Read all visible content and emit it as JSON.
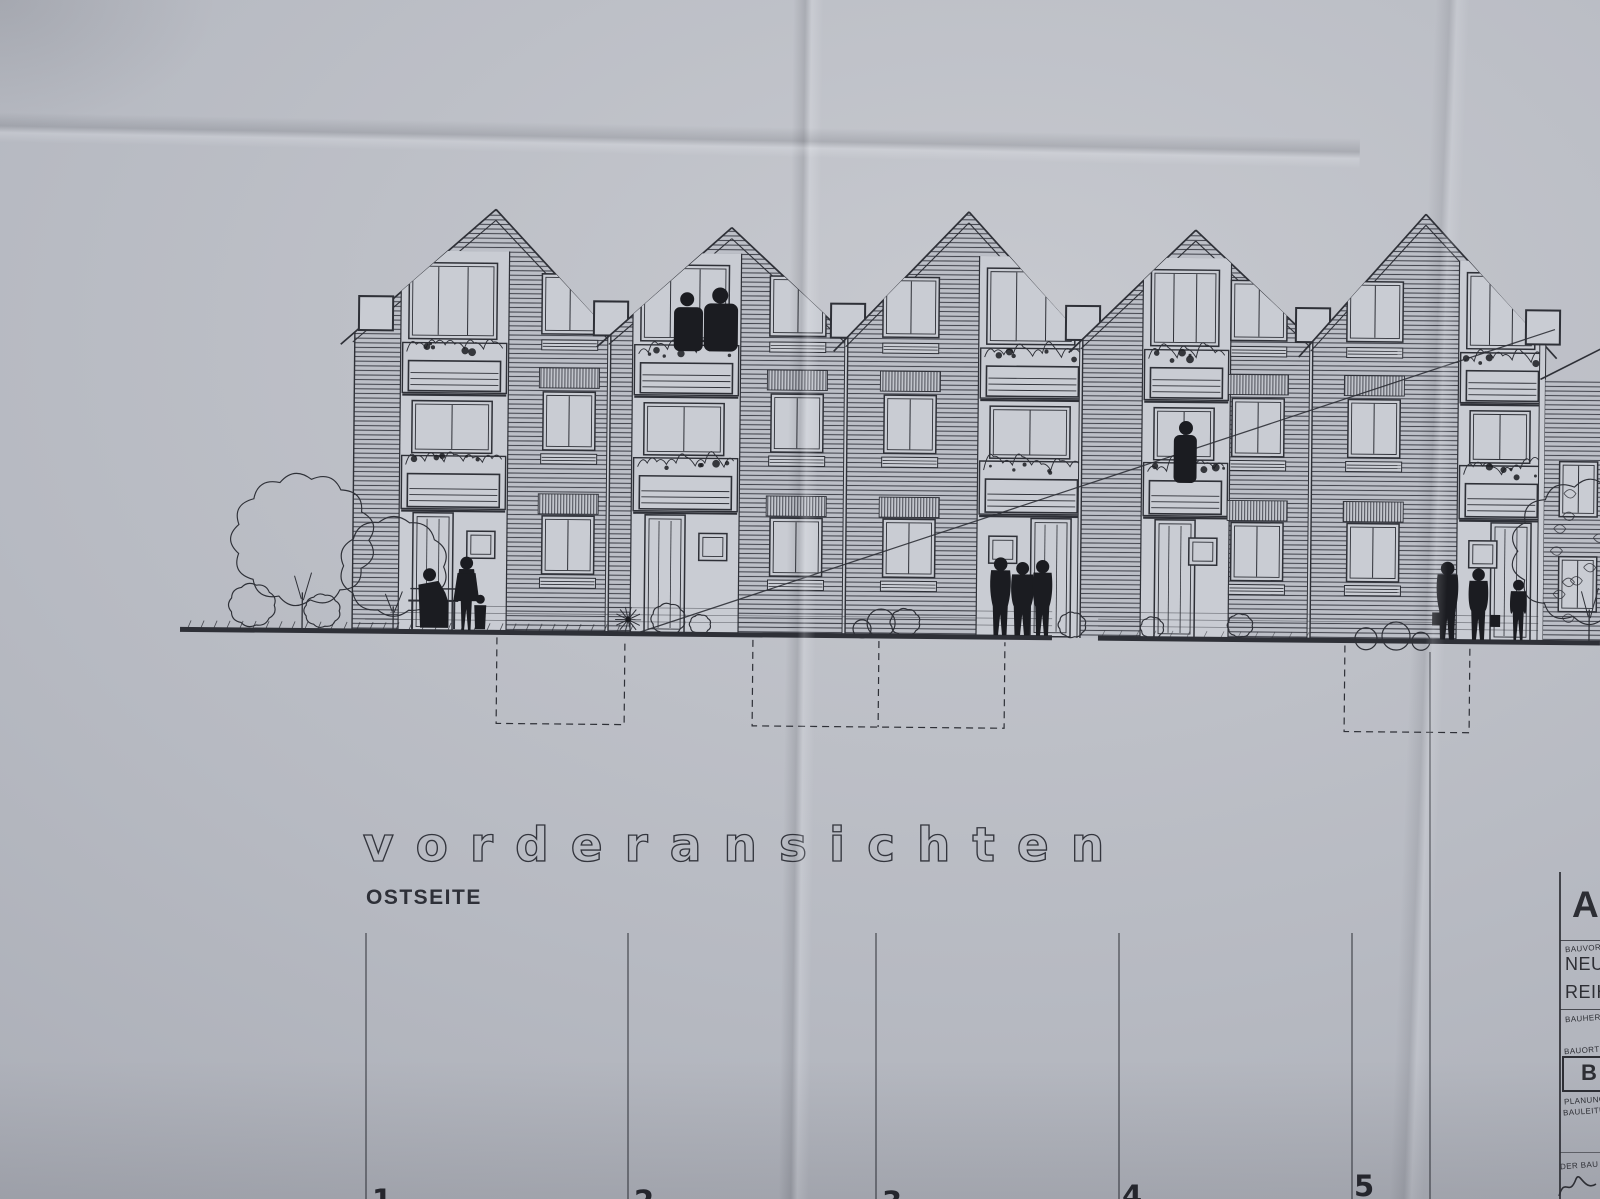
{
  "photo": {
    "description": "photograph of a photocopied architectural front-elevation drawing of gabled row houses on creased paper",
    "paper_color": "#b7bac2",
    "ink_color": "#2e3037",
    "window_paper_color": "#c9ccd3",
    "silhouette_color": "#1b1c21"
  },
  "titles": {
    "main": "vorderansichten",
    "sub": "OSTSEITE"
  },
  "grid": {
    "labels": [
      "1",
      "2",
      "3",
      "4",
      "5"
    ]
  },
  "title_block": {
    "heading": "A",
    "project_label": "BAUVOR",
    "project_line1": "NEU",
    "project_line2": "REIH",
    "client_label": "BAUHER",
    "site_label": "BAUORT",
    "boxed_letter": "B",
    "planning_label": "PLANUNG",
    "supervision_label": "BAULEITU",
    "footer_label": "DER BAU"
  },
  "drawing": {
    "houses_count": 5,
    "floors_per_house": 3,
    "eave_y": 332,
    "ground_y": 631,
    "tilt_deg": 0.55,
    "houses": [
      {
        "x": 352,
        "w": 256,
        "peak": 492,
        "peak_y": 208,
        "bcol": [
          404,
          500
        ],
        "wcx": 567,
        "mirrored": false
      },
      {
        "x": 608,
        "w": 237,
        "peak": 728,
        "peak_y": 224,
        "bcol": [
          636,
          732
        ],
        "wcx": 795,
        "mirrored": false
      },
      {
        "x": 845,
        "w": 235,
        "peak": 965,
        "peak_y": 206,
        "bcol": [
          982,
          1078
        ],
        "wcx": 908,
        "mirrored": true
      },
      {
        "x": 1080,
        "w": 230,
        "peak": 1192,
        "peak_y": 222,
        "bcol": [
          1146,
          1222
        ],
        "wcx": 1256,
        "mirrored": false
      },
      {
        "x": 1310,
        "w": 230,
        "peak": 1422,
        "peak_y": 204,
        "bcol": [
          1462,
          1538
        ],
        "wcx": 1372,
        "mirrored": true
      }
    ],
    "partial_house": {
      "x": 1540,
      "w": 60
    },
    "ground_segments": [
      [
        180,
        1052
      ],
      [
        1098,
        1600
      ]
    ],
    "basement_boxes": [
      {
        "x1": 497,
        "x2": 625
      },
      {
        "x1": 753,
        "x2": 1005,
        "mid": 879
      },
      {
        "x1": 1345,
        "x2": 1470
      }
    ],
    "basement_y": [
      636,
      722
    ],
    "diagonal_line": {
      "x1": 638,
      "y1": 630,
      "x2": 1552,
      "y2": 318
    },
    "grid_lines": {
      "y_top": 933,
      "xs": [
        366,
        628,
        876,
        1119,
        1352
      ],
      "numbers": [
        {
          "label_index": 0,
          "x": 372,
          "y": 1210
        },
        {
          "label_index": 1,
          "x": 634,
          "y": 1211
        },
        {
          "label_index": 2,
          "x": 882,
          "y": 1212
        },
        {
          "label_index": 3,
          "x": 1122,
          "y": 1206
        },
        {
          "label_index": 4,
          "x": 1354,
          "y": 1196
        }
      ],
      "extra_line": {
        "x": 1430,
        "y1": 652,
        "y2": 1199
      }
    },
    "trees": [
      {
        "name": "large-tree",
        "cx": 302,
        "cy": 540,
        "r": 66
      },
      {
        "name": "medium-tree",
        "cx": 393,
        "cy": 566,
        "r": 50
      },
      {
        "name": "bush-left-1",
        "cx": 252,
        "cy": 606,
        "r": 22
      },
      {
        "name": "bush-left-2",
        "cx": 322,
        "cy": 611,
        "r": 17
      },
      {
        "name": "right-tree",
        "cx": 1589,
        "cy": 540,
        "r": 72
      }
    ],
    "ground_circles": [
      [
        862,
        624,
        9
      ],
      [
        881,
        618,
        14
      ],
      [
        1366,
        629,
        11
      ],
      [
        1396,
        626,
        14
      ],
      [
        1421,
        631,
        9
      ]
    ],
    "bushes": [
      [
        668,
        616,
        16
      ],
      [
        700,
        621,
        10
      ],
      [
        905,
        617,
        14
      ],
      [
        1072,
        618,
        13
      ],
      [
        1152,
        620,
        11
      ],
      [
        1240,
        617,
        12
      ]
    ],
    "people": [
      {
        "name": "person-on-bench",
        "x": 430
      },
      {
        "name": "woman-standing",
        "x": 466
      },
      {
        "name": "child",
        "x": 480
      },
      {
        "name": "couple-on-balcony",
        "x": 700
      },
      {
        "name": "three-passersby",
        "x": 1020
      },
      {
        "name": "person-at-balcony-door",
        "x": 1184
      },
      {
        "name": "two-shoppers",
        "x": 1460
      },
      {
        "name": "person-far-right",
        "x": 1518
      }
    ]
  }
}
